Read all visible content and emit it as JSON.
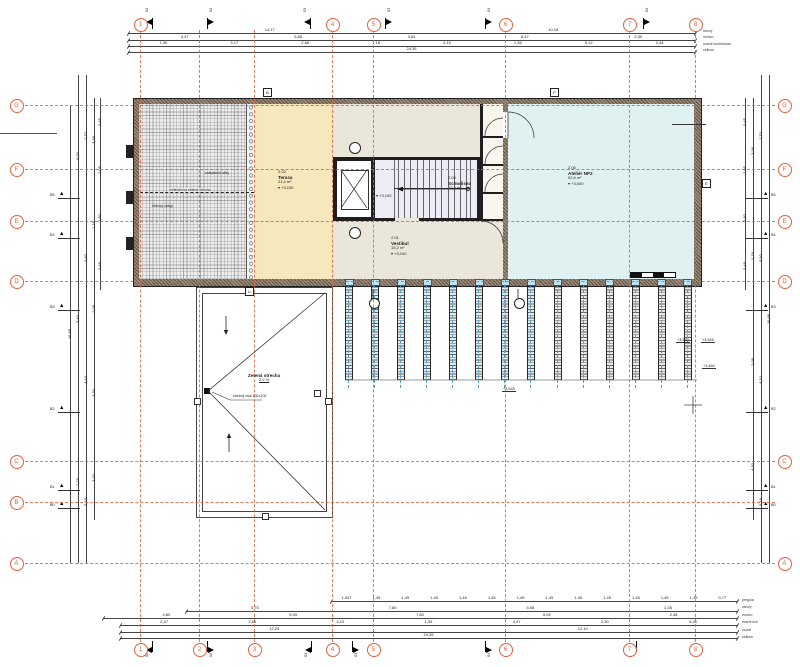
{
  "colors": {
    "grid": "#e2603e",
    "wall": "#9b8b7a",
    "core": "#1f1f1f",
    "dim": "#444",
    "yellow": "#f7e7bd",
    "beige": "#eae6d9",
    "blue": "#e0f1f2",
    "stair": "#edecf6",
    "blueaxis": "#4aa0d8"
  },
  "grid": {
    "cols": [
      {
        "id": "1",
        "x": 140,
        "top": true
      },
      {
        "id": "2",
        "x": 199,
        "top": false
      },
      {
        "id": "3",
        "x": 254,
        "top": false
      },
      {
        "id": "4",
        "x": 332,
        "top": true
      },
      {
        "id": "5",
        "x": 373,
        "top": true
      },
      {
        "id": "6",
        "x": 505,
        "top": true
      },
      {
        "id": "7",
        "x": 629,
        "top": true
      },
      {
        "id": "8",
        "x": 695,
        "top": true
      }
    ],
    "rows": [
      {
        "id": "G",
        "y": 105,
        "right": true
      },
      {
        "id": "F",
        "y": 169,
        "right": true
      },
      {
        "id": "E",
        "y": 221,
        "right": true
      },
      {
        "id": "D",
        "y": 281,
        "right": true
      },
      {
        "id": "C",
        "y": 461,
        "right": true
      },
      {
        "id": "B",
        "y": 502,
        "right": false
      },
      {
        "id": "A",
        "y": 563,
        "right": true
      }
    ]
  },
  "rooms": {
    "terrace": {
      "code": "2.02",
      "name": "Terasa",
      "area": "21,4 m²",
      "level": "▾ +3,100"
    },
    "stair": {
      "code": "2.04",
      "name": "Schodisko",
      "area": "12,8 m²",
      "level": "▾ +3,100"
    },
    "vestibule": {
      "code": "2.01",
      "name": "Vestibul",
      "area": "15,2 m²",
      "level": "▾ +3,100"
    },
    "studio": {
      "code": "2.05",
      "name": "Ateliér NP2",
      "area": "92,6 m²",
      "level": "▾ +3,000"
    },
    "roof": {
      "name": "Zelená strecha",
      "slope": "2,0 %",
      "drain": "strešný vtok 100×100"
    },
    "hatch_labels": [
      "zateplenie átiky",
      "extenzívna zelená strecha",
      "štrkový zásyp"
    ]
  },
  "dims": {
    "h": [
      {
        "y": 33,
        "x1": 128,
        "x2": 695,
        "v": [
          "14,17",
          "10,18"
        ]
      },
      {
        "y": 40,
        "x1": 128,
        "x2": 695,
        "v": [
          "4,47",
          "5,86",
          "3,84",
          "6,47",
          "3,30"
        ]
      },
      {
        "y": 46,
        "x1": 128,
        "x2": 695,
        "v": [
          "1,30",
          "3,17",
          "2,66",
          "1,18",
          "4,10",
          "1,35",
          "5,12",
          "2,44"
        ]
      },
      {
        "y": 52,
        "x1": 128,
        "x2": 695,
        "v": [
          "24,35"
        ]
      },
      {
        "y": 601,
        "x1": 331,
        "x2": 737,
        "v": [
          "1,547",
          "1,45",
          "1,45",
          "1,45",
          "1,45",
          "1,45",
          "1,45",
          "1,45",
          "1,45",
          "1,45",
          "1,45",
          "1,45",
          "1,45",
          "0,77"
        ]
      },
      {
        "y": 611,
        "x1": 186,
        "x2": 737,
        "v": [
          "5,75",
          "7,80",
          "5,55",
          "2,35"
        ]
      },
      {
        "y": 618,
        "x1": 103,
        "x2": 737,
        "v": [
          "4,80",
          "5,05",
          "7,80",
          "5,05",
          "2,48"
        ]
      },
      {
        "y": 625,
        "x1": 120,
        "x2": 737,
        "v": [
          "2,47",
          "2,66",
          "4,10",
          "1,35",
          "4,47",
          "2,30",
          "4,20"
        ]
      },
      {
        "y": 632,
        "x1": 120,
        "x2": 737,
        "v": [
          "12,25",
          "12,10"
        ]
      },
      {
        "y": 638,
        "x1": 120,
        "x2": 737,
        "v": [
          "24,35"
        ]
      }
    ],
    "vl": [
      {
        "x": 70,
        "y1": 105,
        "y2": 563,
        "v": [
          "16,86"
        ]
      },
      {
        "x": 78,
        "y1": 75,
        "y2": 563,
        "v": [
          "6,20",
          "3,40",
          "7,26"
        ]
      },
      {
        "x": 86,
        "y1": 75,
        "y2": 563,
        "v": [
          "1,70",
          "5,90",
          "4,10",
          "5,16"
        ]
      },
      {
        "x": 94,
        "y1": 98,
        "y2": 520,
        "v": [
          "3,38",
          "1,76",
          "2,08",
          "4,30",
          "3,40"
        ]
      },
      {
        "x": 100,
        "y1": 98,
        "y2": 290,
        "v": [
          "0,45",
          "2,95",
          "1,80",
          "0,48"
        ]
      }
    ],
    "vr": [
      {
        "x": 745,
        "y1": 98,
        "y2": 290,
        "v": [
          "0,45",
          "2,95",
          "1,80",
          "0,48"
        ]
      },
      {
        "x": 753,
        "y1": 98,
        "y2": 520,
        "v": [
          "3,38",
          "1,76",
          "2,08",
          "4,30"
        ]
      },
      {
        "x": 761,
        "y1": 75,
        "y2": 563,
        "v": [
          "1,70",
          "5,90",
          "4,10",
          "5,16"
        ]
      },
      {
        "x": 769,
        "y1": 75,
        "y2": 563,
        "v": [
          "16,86"
        ]
      }
    ],
    "top_legend": [
      "otvory",
      "murivo",
      "nosné konštrukcie",
      "celkom"
    ],
    "bottom_legend": [
      "pergola",
      "otvory",
      "murivo",
      "nosné kce",
      "osové",
      "celkom"
    ]
  },
  "flags": {
    "top": [
      {
        "x": 152,
        "d": -1,
        "t": "S2"
      },
      {
        "x": 207,
        "d": 1,
        "t": "S2"
      },
      {
        "x": 310,
        "d": -1,
        "t": "S3"
      },
      {
        "x": 385,
        "d": 1,
        "t": "S3"
      },
      {
        "x": 485,
        "d": 1,
        "t": "S4"
      },
      {
        "x": 643,
        "d": 1,
        "t": "S4"
      }
    ],
    "bottom": [
      {
        "x": 152,
        "d": -1,
        "t": "S2"
      },
      {
        "x": 207,
        "d": 1,
        "t": "S2"
      },
      {
        "x": 311,
        "d": -1,
        "t": "S3"
      },
      {
        "x": 352,
        "d": 1,
        "t": "S3"
      },
      {
        "x": 485,
        "d": 1,
        "t": "S4"
      },
      {
        "x": 636,
        "d": -1,
        "t": "S4"
      }
    ]
  },
  "bmarkers": {
    "labels": [
      "B5",
      "B4",
      "B3",
      "B2",
      "B1",
      "B0"
    ],
    "ys": [
      197,
      237,
      309,
      411,
      489,
      507
    ]
  },
  "wall_marks": [
    {
      "t": "B",
      "x": 263,
      "y": 88
    },
    {
      "t": "P",
      "x": 550,
      "y": 88
    },
    {
      "t": "E",
      "x": 702,
      "y": 179
    },
    {
      "t": "b",
      "x": 245,
      "y": 287
    }
  ],
  "roof_squares": [
    [
      194,
      398
    ],
    [
      325,
      398
    ],
    [
      262,
      513
    ],
    [
      314,
      390
    ]
  ],
  "spot_levels": [
    {
      "t": "+3,545",
      "x": 676,
      "y": 338
    },
    {
      "t": "+3,545",
      "x": 701,
      "y": 338
    },
    {
      "t": "+3,460",
      "x": 702,
      "y": 364
    },
    {
      "t": "+3,545",
      "x": 502,
      "y": 387
    }
  ],
  "pergola": {
    "x0": 345,
    "count": 14,
    "step": 26.07,
    "w": 6,
    "y1": 287,
    "y2": 380
  }
}
